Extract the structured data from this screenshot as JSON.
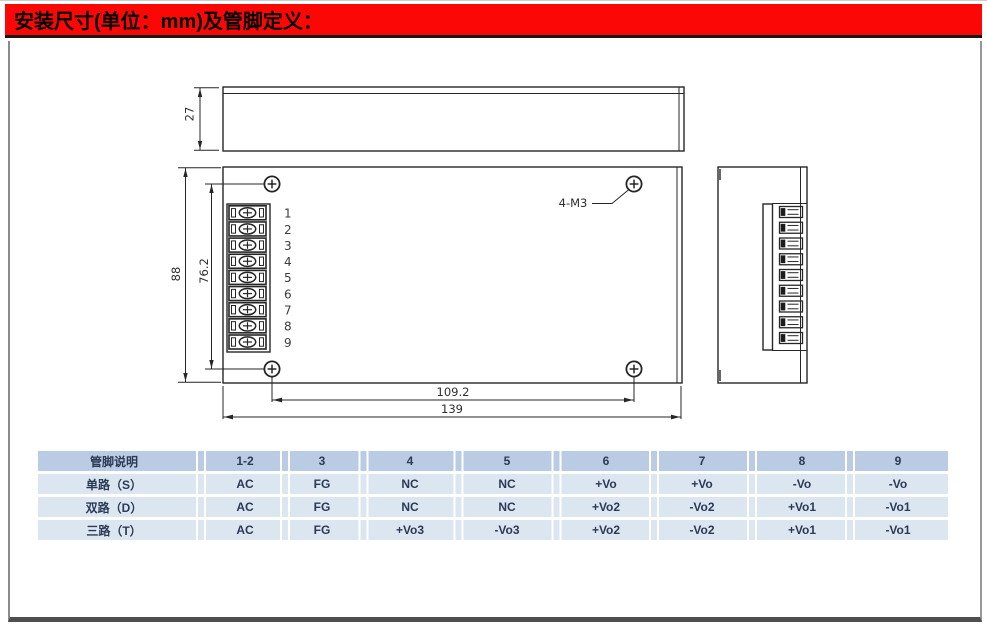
{
  "header": {
    "title": "安装尺寸(单位：mm)及管脚定义："
  },
  "drawing": {
    "dims": {
      "top_view_height": "27",
      "front_height": "88",
      "mount_hole_spacing_v": "76.2",
      "mount_hole_spacing_h": "109.2",
      "overall_width": "139",
      "mount_hole_label": "4-M3"
    },
    "pins": [
      "1",
      "2",
      "3",
      "4",
      "5",
      "6",
      "7",
      "8",
      "9"
    ]
  },
  "pin_table": {
    "headers": [
      "管脚说明",
      "1-2",
      "3",
      "4",
      "5",
      "6",
      "7",
      "8",
      "9"
    ],
    "rows": [
      {
        "label": "单路（S）",
        "values": [
          "AC",
          "FG",
          "NC",
          "NC",
          "+Vo",
          "+Vo",
          "-Vo",
          "-Vo"
        ]
      },
      {
        "label": "双路（D）",
        "values": [
          "AC",
          "FG",
          "NC",
          "NC",
          "+Vo2",
          "-Vo2",
          "+Vo1",
          "-Vo1"
        ]
      },
      {
        "label": "三路（T）",
        "values": [
          "AC",
          "FG",
          "+Vo3",
          "-Vo3",
          "+Vo2",
          "-Vo2",
          "+Vo1",
          "-Vo1"
        ]
      }
    ]
  },
  "colors": {
    "accent_red": "#fb0806",
    "table_header_bg": "#b9cce3",
    "table_row_bg": "#dce6f1",
    "table_text": "#2b3a55",
    "drawing_line": "#262626"
  }
}
